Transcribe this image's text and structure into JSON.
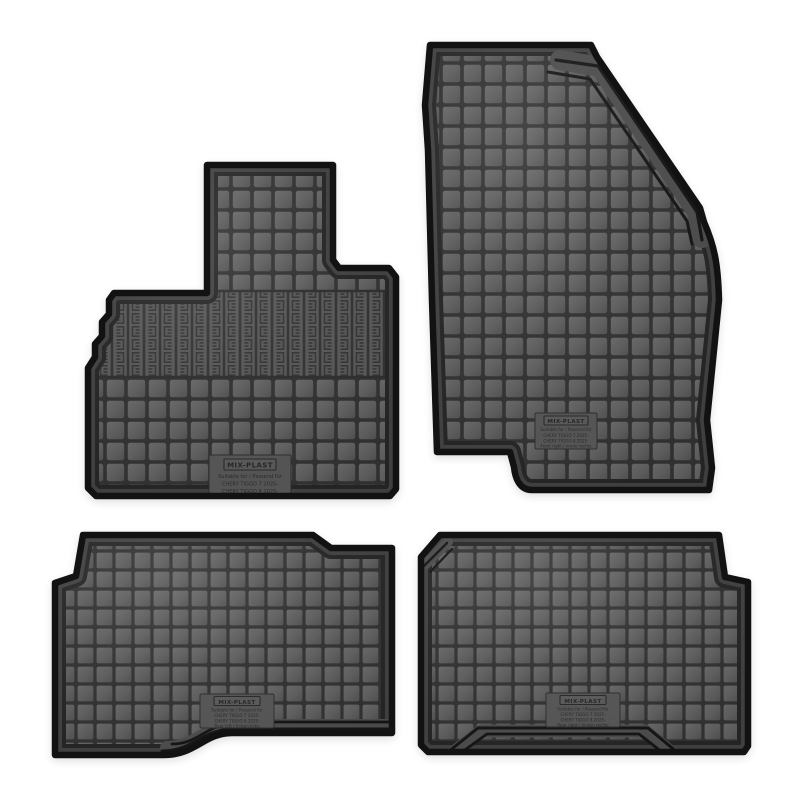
{
  "photo": {
    "subject": "set of four black rubber car floor mats on white background",
    "background_color": "#ffffff",
    "mat_surface_color": "#5b5b5b",
    "groove_color": "#303030",
    "rim_color": "#3f3f3f",
    "edge_color": "#121212"
  },
  "mats": [
    {
      "name": "front left mat",
      "label": {
        "brand": "MIX-PLAST",
        "suitable": "Suitable for / Passend für",
        "model1": "CHERY TIGGO 7  2025-",
        "model2": "CHERY TIGGO 8  2025-",
        "position": "Front left / vorne links"
      }
    },
    {
      "name": "front right mat",
      "label": {
        "brand": "MIX-PLAST",
        "suitable": "Suitable for / Passend für",
        "model1": "CHERY TIGGO 7  2025-",
        "model2": "CHERY TIGGO 8  2025-",
        "position": "Front right / vorne rechts"
      }
    },
    {
      "name": "rear left mat",
      "label": {
        "brand": "MIX-PLAST",
        "suitable": "Suitable for / Passend für",
        "model1": "CHERY TIGGO 7  2025-",
        "model2": "CHERY TIGGO 8  2025-",
        "position": "Rear left / hinten links"
      }
    },
    {
      "name": "rear right mat",
      "label": {
        "brand": "MIX-PLAST",
        "suitable": "Suitable for / Passend für",
        "model1": "CHERY TIGGO 7  2025-",
        "model2": "CHERY TIGGO 8  2025-",
        "position": "Rear right / hinten rechts"
      }
    }
  ]
}
